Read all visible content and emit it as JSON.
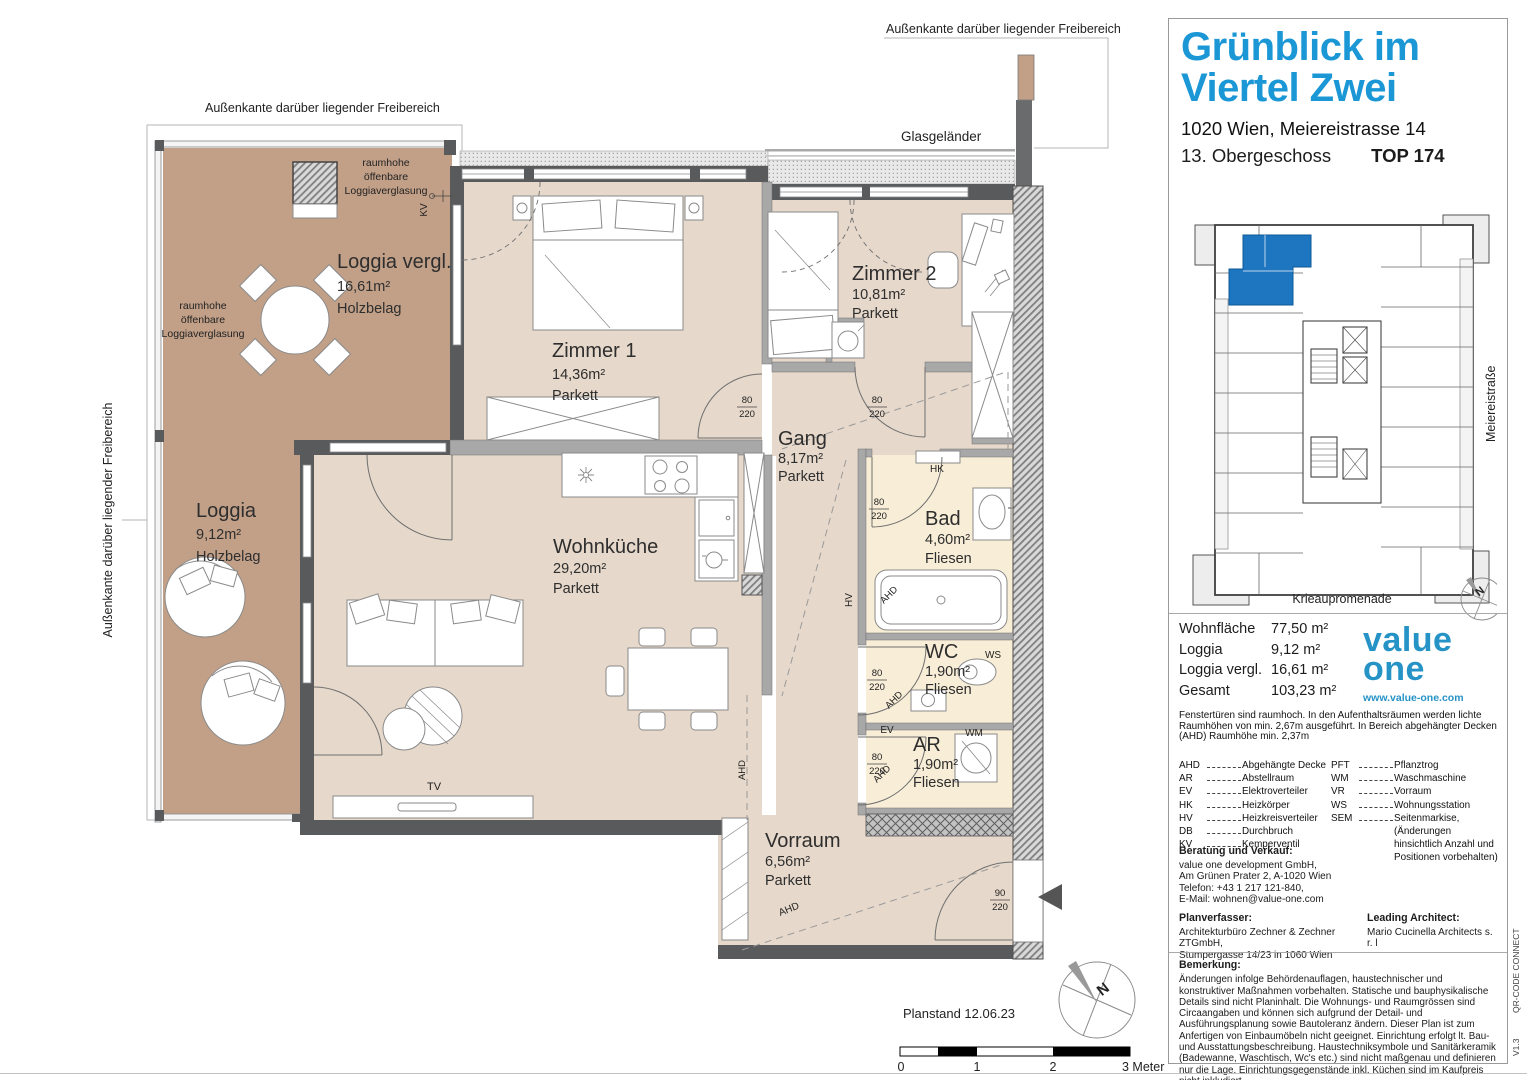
{
  "title_block": {
    "project_line1": "Grünblick im",
    "project_line2": "Viertel Zwei",
    "address": "1020 Wien, Meiereistrasse 14",
    "floor": "13. Obergeschoss",
    "unit": "TOP 174",
    "accent_color": "#1b97d6"
  },
  "overview": {
    "street_right": "Meiereistraße",
    "street_bottom": "Krieaupromenade",
    "highlight_color": "#1e76c0",
    "labels": [
      {
        "name": "north-label",
        "text": "N",
        "x": 291,
        "y": 385,
        "size": 11,
        "rot": -38,
        "anchor": "middle",
        "weight": "bold"
      }
    ]
  },
  "areas": {
    "rows": [
      {
        "label": "Wohnfläche",
        "value": "77,50 m²"
      },
      {
        "label": "Loggia",
        "value": "9,12 m²"
      },
      {
        "label": "Loggia vergl.",
        "value": "16,61 m²"
      },
      {
        "label": "Gesamt",
        "value": "103,23 m²"
      }
    ]
  },
  "logo": {
    "line1": "value",
    "line2": "one",
    "url": "www.value-one.com"
  },
  "note_raumhoehe": "Fenstertüren sind raumhoch. In den Aufenthaltsräumen werden lichte Raumhöhen von min. 2,67m ausgeführt. In Bereich abgehängter Decken (AHD) Raumhöhe min. 2,37m",
  "legend": {
    "col1": [
      {
        "abbr": "AHD",
        "term": "Abgehängte Decke"
      },
      {
        "abbr": "AR",
        "term": "Abstellraum"
      },
      {
        "abbr": "EV",
        "term": "Elektroverteiler"
      },
      {
        "abbr": "HK",
        "term": "Heizkörper"
      },
      {
        "abbr": "HV",
        "term": "Heizkreisverteiler"
      },
      {
        "abbr": "DB",
        "term": "Durchbruch"
      },
      {
        "abbr": "KV",
        "term": "Kemperventil"
      }
    ],
    "col2": [
      {
        "abbr": "PFT",
        "term": "Pflanztrog"
      },
      {
        "abbr": "WM",
        "term": "Waschmaschine"
      },
      {
        "abbr": "VR",
        "term": "Vorraum"
      },
      {
        "abbr": "WS",
        "term": "Wohnungsstation"
      },
      {
        "abbr": "SEM",
        "term": "Seitenmarkise, (Änderungen hinsichtlich Anzahl und Positionen vorbehalten)"
      }
    ]
  },
  "contact": {
    "title": "Beratung und Verkauf:",
    "lines": [
      "value one development GmbH,",
      "Am Grünen Prater 2, A-1020 Wien",
      "Telefon: +43 1 217 121-840,",
      "E-Mail: wohnen@value-one.com"
    ]
  },
  "planner": {
    "title": "Planverfasser:",
    "lines": [
      "Architekturbüro Zechner & Zechner ZTGmbH,",
      "Stumpergasse 14/23 in 1060 Wien"
    ]
  },
  "architect": {
    "title": "Leading Architect:",
    "lines": [
      "Mario Cucinella Architects s. r. l"
    ]
  },
  "remark": {
    "title": "Bemerkung:",
    "text": "Änderungen infolge Behördenauflagen, haustechnischer und konstruktiver Maßnahmen vorbehalten. Statische und bauphysikalische Details sind nicht Planinhalt. Die Wohnungs- und Raumgrössen sind Circaangaben und können sich aufgrund der Detail- und Ausführungsplanung sowie Bautoleranz ändern. Dieser Plan ist zum Anfertigen von Einbaumöbeln nicht geeignet. Einrichtung erfolgt lt. Bau- und Ausstattungsbeschreibung. Haustechniksymbole und Sanitärkeramik (Badewanne, Waschtisch, Wc's etc.) sind nicht maßgenau und definieren nur die Lage. Einrichtungsgegenstände inkl. Küchen sind im Kaufpreis nicht inkludiert."
  },
  "side_labels": {
    "qr": "QR-CODE CONNECT",
    "version": "V1.3"
  },
  "plan": {
    "colors": {
      "loggia": "#c2a088",
      "room": "#e6d8ca",
      "wet": "#f8edd7",
      "wall": "#595a5c"
    },
    "rooms": [
      {
        "name": "Loggia vergl.",
        "area": "16,61m²",
        "floor": "Holzbelag",
        "x": 337,
        "ys": [
          268,
          291,
          313
        ]
      },
      {
        "name": "Loggia",
        "area": "9,12m²",
        "floor": "Holzbelag",
        "x": 196,
        "ys": [
          517,
          539,
          561
        ]
      },
      {
        "name": "Zimmer 1",
        "area": "14,36m²",
        "floor": "Parkett",
        "x": 552,
        "ys": [
          357,
          379,
          400
        ]
      },
      {
        "name": "Zimmer 2",
        "area": "10,81m²",
        "floor": "Parkett",
        "x": 852,
        "ys": [
          280,
          299,
          318
        ]
      },
      {
        "name": "Gang",
        "area": "8,17m²",
        "floor": "Parkett",
        "x": 778,
        "ys": [
          445,
          463,
          481
        ]
      },
      {
        "name": "Wohnküche",
        "area": "29,20m²",
        "floor": "Parkett",
        "x": 553,
        "ys": [
          553,
          573,
          593
        ]
      },
      {
        "name": "Bad",
        "area": "4,60m²",
        "floor": "Fliesen",
        "x": 925,
        "ys": [
          525,
          544,
          563
        ]
      },
      {
        "name": "WC",
        "area": "1,90m²",
        "floor": "Fliesen",
        "x": 925,
        "ys": [
          658,
          676,
          694
        ]
      },
      {
        "name": "AR",
        "area": "1,90m²",
        "floor": "Fliesen",
        "x": 913,
        "ys": [
          751,
          769,
          787
        ]
      },
      {
        "name": "Vorraum",
        "area": "6,56m²",
        "floor": "Parkett",
        "x": 765,
        "ys": [
          847,
          866,
          885
        ]
      }
    ],
    "labels": [
      {
        "name": "aussenkante-top-left",
        "text": "Außenkante darüber liegender Freibereich",
        "x": 205,
        "y": 112,
        "size": 12.5
      },
      {
        "name": "aussenkante-top-right",
        "text": "Außenkante darüber liegender Freibereich",
        "x": 886,
        "y": 33,
        "size": 12.5
      },
      {
        "name": "aussenkante-left",
        "text": "Außenkante darüber liegender Freibereich",
        "x": 112,
        "y": 520,
        "size": 12.5,
        "rot": -90,
        "anchor": "middle"
      },
      {
        "name": "glasgelaender-label",
        "text": "Glasgeländer",
        "x": 901,
        "y": 141,
        "size": 13.5
      },
      {
        "name": "verglasung-label",
        "text": "raumhohe",
        "x": 386,
        "y": 166,
        "size": 10.5,
        "anchor": "middle"
      },
      {
        "name": "verglasung-label",
        "text": "öffenbare",
        "x": 386,
        "y": 180,
        "size": 10.5,
        "anchor": "middle"
      },
      {
        "name": "verglasung-label",
        "text": "Loggiaverglasung",
        "x": 386,
        "y": 194,
        "size": 10.5,
        "anchor": "middle"
      },
      {
        "name": "verglasung-label",
        "text": "raumhohe",
        "x": 203,
        "y": 309,
        "size": 10.5,
        "anchor": "middle"
      },
      {
        "name": "verglasung-label",
        "text": "öffenbare",
        "x": 203,
        "y": 323,
        "size": 10.5,
        "anchor": "middle"
      },
      {
        "name": "verglasung-label",
        "text": "Loggiaverglasung",
        "x": 203,
        "y": 337,
        "size": 10.5,
        "anchor": "middle"
      },
      {
        "name": "kv-label",
        "text": "KV",
        "x": 427,
        "y": 210,
        "size": 10,
        "rot": -90,
        "anchor": "middle"
      },
      {
        "name": "hk-label",
        "text": "HK",
        "x": 937,
        "y": 472,
        "size": 10,
        "anchor": "middle"
      },
      {
        "name": "hv-label",
        "text": "HV",
        "x": 852,
        "y": 600,
        "size": 10,
        "rot": -90,
        "anchor": "middle"
      },
      {
        "name": "ws-label",
        "text": "WS",
        "x": 993,
        "y": 658,
        "size": 10,
        "anchor": "middle"
      },
      {
        "name": "ev-label",
        "text": "EV",
        "x": 887,
        "y": 733,
        "size": 10,
        "anchor": "middle"
      },
      {
        "name": "wm-label",
        "text": "WM",
        "x": 974,
        "y": 736,
        "size": 10,
        "anchor": "middle"
      },
      {
        "name": "tv-label",
        "text": "TV",
        "x": 434,
        "y": 790,
        "size": 11,
        "anchor": "middle"
      },
      {
        "name": "ahd-label",
        "text": "AHD",
        "x": 891,
        "y": 597,
        "size": 9.5,
        "rot": -45,
        "anchor": "middle"
      },
      {
        "name": "ahd-label",
        "text": "AHD",
        "x": 896,
        "y": 702,
        "size": 9.5,
        "rot": -45,
        "anchor": "middle"
      },
      {
        "name": "ahd-label",
        "text": "AHD",
        "x": 884,
        "y": 776,
        "size": 9.5,
        "rot": -45,
        "anchor": "middle"
      },
      {
        "name": "ahd-label",
        "text": "AHD",
        "x": 790,
        "y": 912,
        "size": 10,
        "rot": -22,
        "anchor": "middle"
      },
      {
        "name": "ahd-label",
        "text": "AHD",
        "x": 745,
        "y": 770,
        "size": 9.5,
        "rot": -90,
        "anchor": "middle"
      },
      {
        "name": "door-dim",
        "text": "80",
        "x": 747,
        "y": 403,
        "size": 9.5,
        "anchor": "middle"
      },
      {
        "name": "door-dim",
        "text": "220",
        "x": 747,
        "y": 417,
        "size": 9.5,
        "anchor": "middle"
      },
      {
        "name": "door-dim",
        "text": "80",
        "x": 877,
        "y": 403,
        "size": 9.5,
        "anchor": "middle"
      },
      {
        "name": "door-dim",
        "text": "220",
        "x": 877,
        "y": 417,
        "size": 9.5,
        "anchor": "middle"
      },
      {
        "name": "door-dim",
        "text": "80",
        "x": 879,
        "y": 505,
        "size": 9.5,
        "anchor": "middle"
      },
      {
        "name": "door-dim",
        "text": "220",
        "x": 879,
        "y": 519,
        "size": 9.5,
        "anchor": "middle"
      },
      {
        "name": "door-dim",
        "text": "80",
        "x": 877,
        "y": 676,
        "size": 9.5,
        "anchor": "middle"
      },
      {
        "name": "door-dim",
        "text": "220",
        "x": 877,
        "y": 690,
        "size": 9.5,
        "anchor": "middle"
      },
      {
        "name": "door-dim",
        "text": "80",
        "x": 877,
        "y": 760,
        "size": 9.5,
        "anchor": "middle"
      },
      {
        "name": "door-dim",
        "text": "220",
        "x": 877,
        "y": 774,
        "size": 9.5,
        "anchor": "middle"
      },
      {
        "name": "door-dim",
        "text": "90",
        "x": 1000,
        "y": 896,
        "size": 9.5,
        "anchor": "middle"
      },
      {
        "name": "door-dim",
        "text": "220",
        "x": 1000,
        "y": 910,
        "size": 9.5,
        "anchor": "middle"
      },
      {
        "name": "planstand-label",
        "text": "Planstand 12.06.23",
        "x": 903,
        "y": 1018,
        "size": 13
      },
      {
        "name": "scale-tick",
        "text": "0",
        "x": 901,
        "y": 1071,
        "size": 12.5,
        "anchor": "middle"
      },
      {
        "name": "scale-tick",
        "text": "1",
        "x": 977,
        "y": 1071,
        "size": 12.5,
        "anchor": "middle"
      },
      {
        "name": "scale-tick",
        "text": "2",
        "x": 1053,
        "y": 1071,
        "size": 12.5,
        "anchor": "middle"
      },
      {
        "name": "scale-tick",
        "text": "3 Meter",
        "x": 1122,
        "y": 1071,
        "size": 12.5
      },
      {
        "name": "north-label",
        "text": "N",
        "x": 1106,
        "y": 993,
        "size": 15,
        "rot": -38,
        "anchor": "middle",
        "weight": "bold"
      }
    ]
  }
}
